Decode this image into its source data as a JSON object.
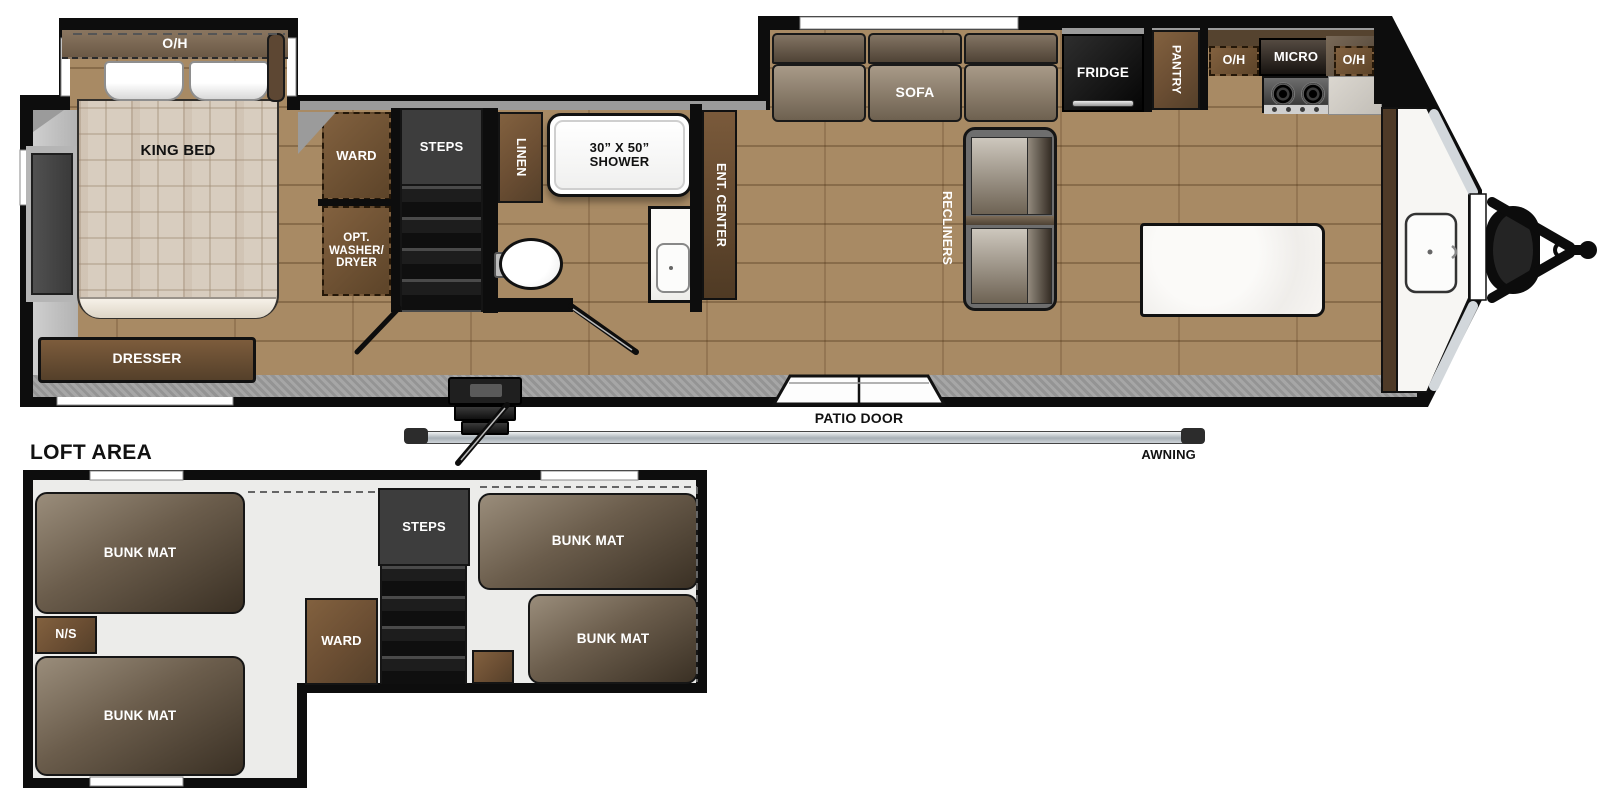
{
  "plan": {
    "bedroom": {
      "overhead": "O/H",
      "bed": "KING BED",
      "dresser": "DRESSER",
      "wardrobe": "WARD",
      "washer_dryer": "OPT.\nWASHER/\nDRYER"
    },
    "hall": {
      "steps": "STEPS",
      "linen": "LINEN"
    },
    "bath": {
      "shower": "30” X 50”\nSHOWER"
    },
    "living": {
      "ent_center": "ENT. CENTER",
      "sofa": "SOFA",
      "recliners": "RECLINERS"
    },
    "kitchen": {
      "fridge": "FRIDGE",
      "pantry": "PANTRY",
      "overhead_left": "O/H",
      "micro": "MICRO",
      "overhead_right": "O/H"
    },
    "exterior": {
      "patio_door": "PATIO DOOR",
      "awning": "AWNING"
    }
  },
  "loft": {
    "title": "LOFT AREA",
    "bunk_mat": "BUNK MAT",
    "nightstand": "N/S",
    "wardrobe": "WARD",
    "steps": "STEPS"
  },
  "colors": {
    "wall": "#0d0d0d",
    "floor_wood": "#a88a64",
    "walkway_gray": "#9f9f9f",
    "cabinet_brown": "#6b4e33",
    "appliance_black": "#1a1a1a",
    "counter_white": "#f7f5f1",
    "loft_floor": "#ececea",
    "mat_brown_light": "#9a8d7b",
    "mat_brown_dark": "#3a3024",
    "awning_silver": "#c9ced3"
  }
}
